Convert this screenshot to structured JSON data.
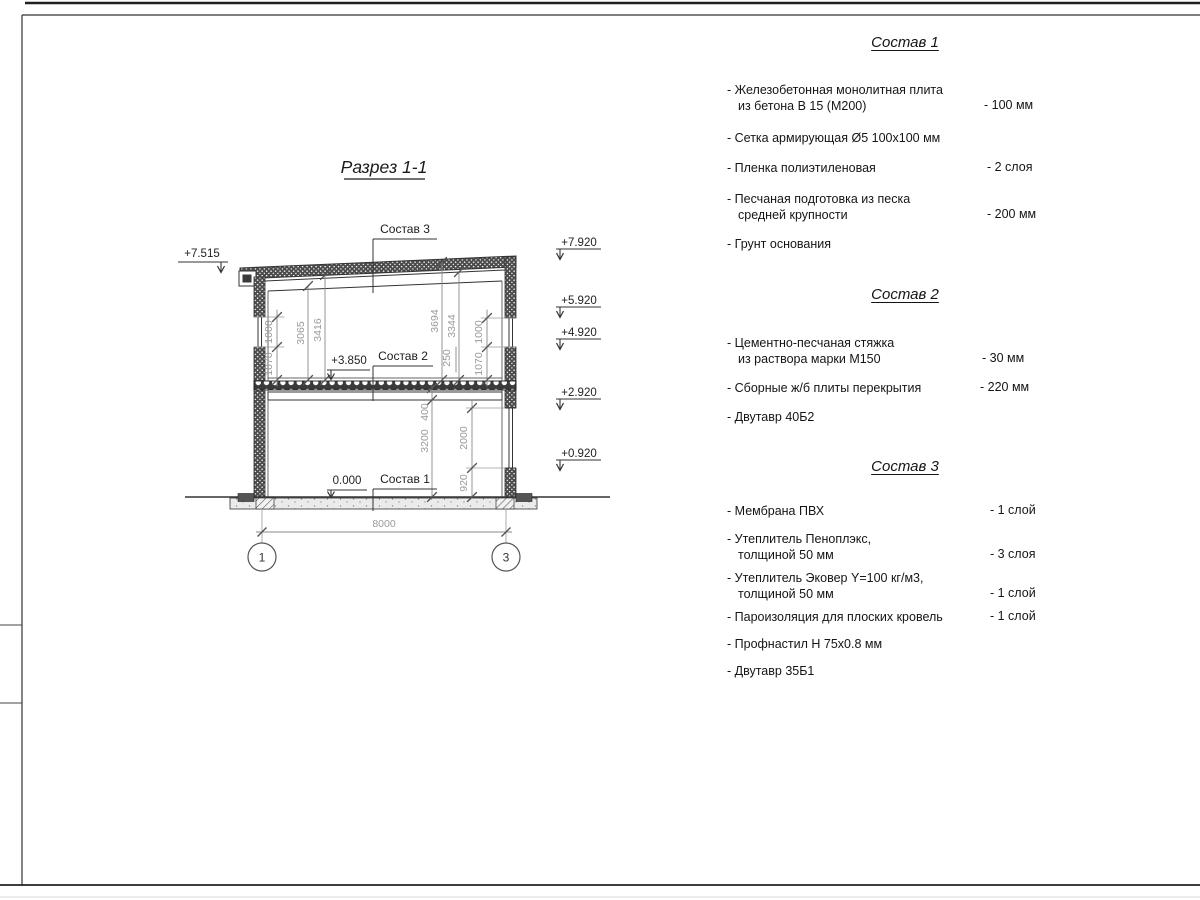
{
  "drawing": {
    "title": "Разрез 1-1",
    "callouts": {
      "c1": "Состав 1",
      "c2": "Состав 2",
      "c3": "Состав 3"
    },
    "elevations": {
      "left_roof": "+7.515",
      "mid_slab": "+3.850",
      "zero": "0.000",
      "right": [
        "+7.920",
        "+5.920",
        "+4.920",
        "+2.920",
        "+0.920"
      ]
    },
    "dims": {
      "left_outer": [
        "1000",
        "1070"
      ],
      "left_inner": [
        "3065",
        "3416"
      ],
      "right_inner": [
        "3694",
        "3344"
      ],
      "right_mid": [
        "250",
        "1070",
        "1000"
      ],
      "right_lower_a": [
        "400",
        "3200"
      ],
      "right_lower_b": [
        "2000",
        "920"
      ],
      "span": "8000"
    },
    "axes": [
      "1",
      "3"
    ]
  },
  "specs": [
    {
      "title": "Состав 1",
      "items": [
        {
          "l1": "- Железобетонная  монолитная плита",
          "l2": "из бетона В 15 (М200)",
          "value": "- 100 мм"
        },
        {
          "l1": "- Сетка армирующая Ø5 100х100 мм",
          "l2": "",
          "value": ""
        },
        {
          "l1": "- Пленка полиэтиленовая",
          "l2": "",
          "value": "-  2 слоя"
        },
        {
          "l1": "- Песчаная подготовка из песка",
          "l2": "средней крупности",
          "value": "- 200 мм"
        },
        {
          "l1": "- Грунт основания",
          "l2": "",
          "value": ""
        }
      ]
    },
    {
      "title": "Состав 2",
      "items": [
        {
          "l1": "- Цементно-песчаная стяжка",
          "l2": "из раствора марки М150",
          "value": "- 30 мм"
        },
        {
          "l1": "- Сборные ж/б плиты перекрытия",
          "l2": "",
          "value": "- 220 мм"
        },
        {
          "l1": "- Двутавр 40Б2",
          "l2": "",
          "value": ""
        }
      ]
    },
    {
      "title": "Состав 3",
      "items": [
        {
          "l1": "- Мембрана ПВХ",
          "l2": "",
          "value": "- 1 слой"
        },
        {
          "l1": "- Утеплитель Пеноплэкс,",
          "l2": "толщиной 50 мм",
          "value": "- 3 слоя"
        },
        {
          "l1": "- Утеплитель Эковер Y=100 кг/м3,",
          "l2": "толщиной 50 мм",
          "value": "- 1 слой"
        },
        {
          "l1": "- Пароизоляция для плоских кровель",
          "l2": "",
          "value": "- 1 слой"
        },
        {
          "l1": "- Профнастил Н 75х0.8 мм",
          "l2": "",
          "value": ""
        },
        {
          "l1": "- Двутавр 35Б1",
          "l2": "",
          "value": ""
        }
      ]
    }
  ]
}
